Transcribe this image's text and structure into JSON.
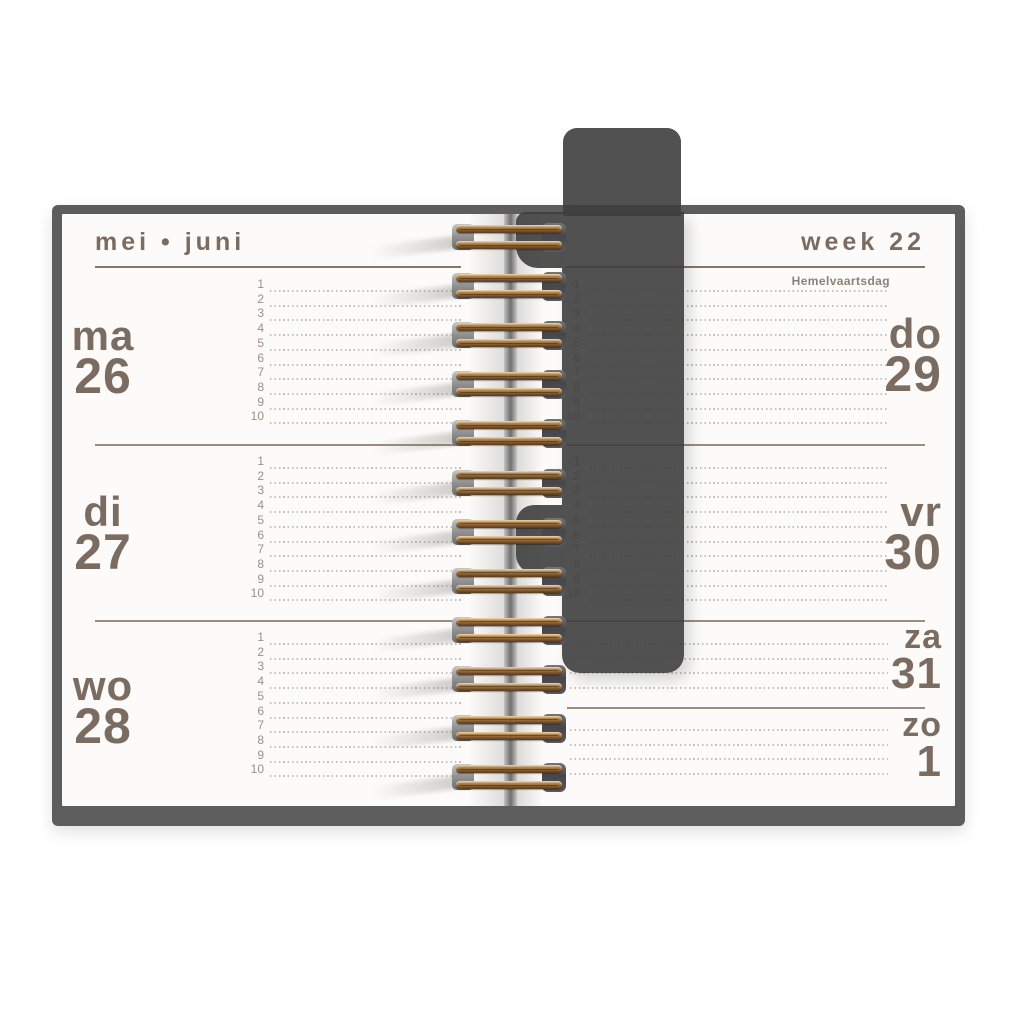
{
  "product": {
    "description": "Spiral wire-bound weekly diary opened on a week spread with a dark clip-on bookmark"
  },
  "colors": {
    "cover": "#5d5d5d",
    "page": "#fcfbf9",
    "ink": "#7b6c62",
    "ink_light": "#9c9084",
    "header_rule": "#857667",
    "divider": "#9a8d80",
    "dotted_line": "#c9c1b8",
    "bookmark": "#3e3e3e",
    "wire_copper": "#a97d49",
    "wire_cap_dark": "#46464a",
    "wire_cap_light": "#9a9a9a"
  },
  "left_page": {
    "month_header": "mei  •  juni",
    "days": [
      {
        "abbr": "ma",
        "date": "26",
        "lines": 10,
        "numbered": true
      },
      {
        "abbr": "di",
        "date": "27",
        "lines": 10,
        "numbered": true
      },
      {
        "abbr": "wo",
        "date": "28",
        "lines": 10,
        "numbered": true
      }
    ]
  },
  "right_page": {
    "week_header": "week 22",
    "holiday": "Hemelvaartsdag",
    "days": [
      {
        "abbr": "do",
        "date": "29",
        "lines": 10,
        "numbered": true
      },
      {
        "abbr": "vr",
        "date": "30",
        "lines": 10,
        "numbered": true
      },
      {
        "abbr": "za",
        "date": "31",
        "lines": 4,
        "numbered": false
      },
      {
        "abbr": "zo",
        "date": "1",
        "lines": 4,
        "numbered": false
      }
    ]
  },
  "binding": {
    "coil_count": 12
  },
  "bookmark": {
    "present": true
  }
}
